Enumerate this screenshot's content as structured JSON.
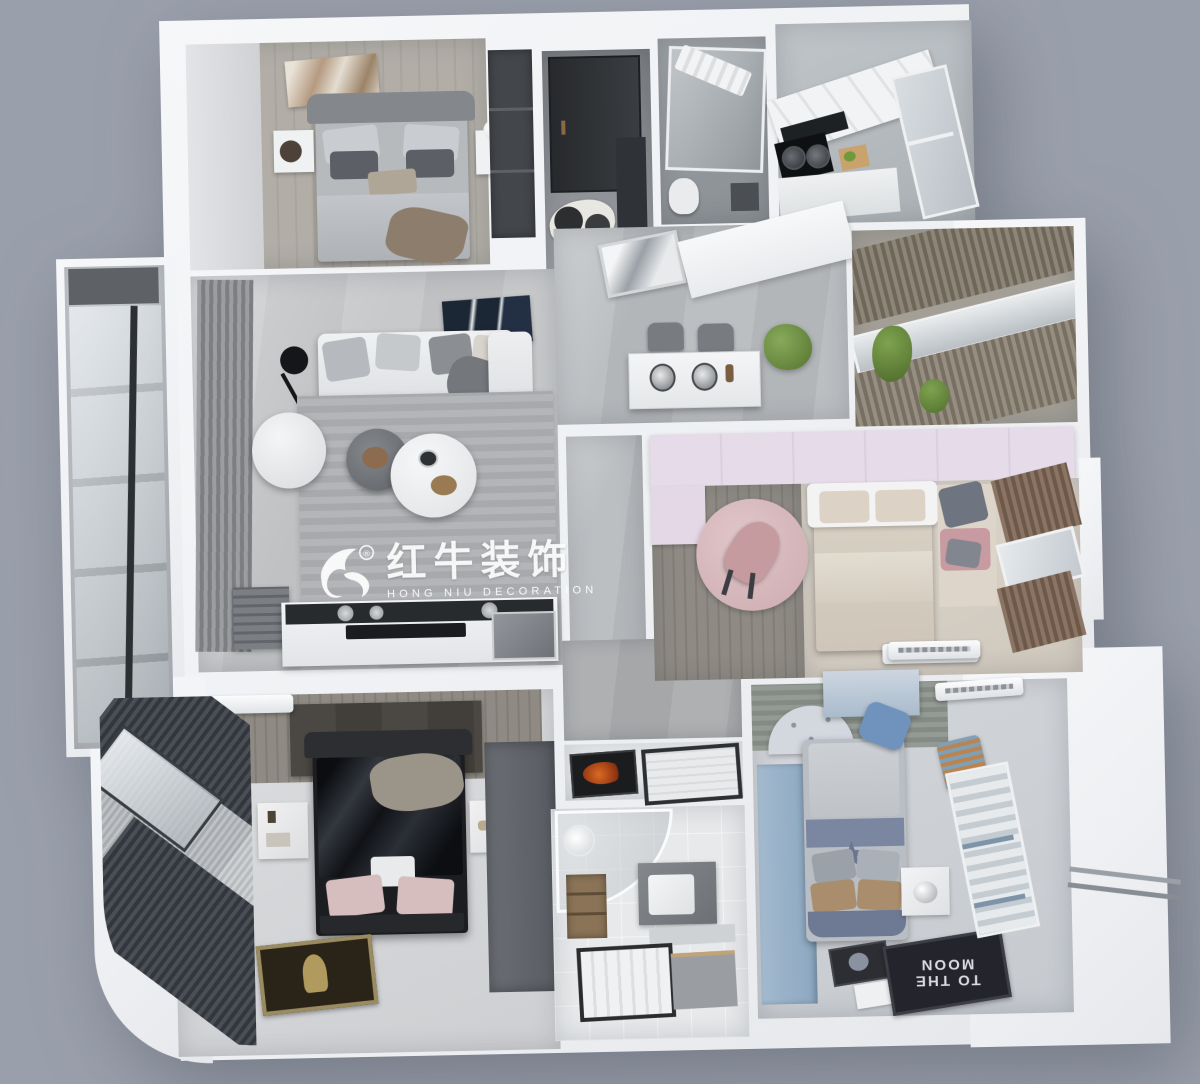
{
  "scene": {
    "description": "Top-down 3D cutaway render of a furnished three-bedroom apartment",
    "background_color": "#9aa0ab",
    "wall_color": "#f3f4f6"
  },
  "watermark": {
    "brand_cn": "红牛装饰",
    "brand_en": "HONG NIU DECORATION",
    "registered": "®"
  },
  "texts": {
    "moon_rug": "TO THE MOON"
  },
  "palette": {
    "gray_wood_floor": "#b0aca5",
    "marble_floor": "#bcbfc2",
    "entry_tile": "#85888c",
    "master_floor": "#d8d9db",
    "kids_blue": "#9db4ca",
    "kids_pink_wardrobe": "#e2d6e4",
    "pink_rug": "#d9bbbe",
    "black_bed": "#15171b",
    "plant_green": "#6b8a46",
    "flame_mat_orange": "#c8511e"
  },
  "rooms": [
    {
      "id": "second-bedroom",
      "furniture": [
        "gray double bed",
        "two white nightstands",
        "abstract artwork",
        "table lamp",
        "dark wardrobe"
      ]
    },
    {
      "id": "entry-hall",
      "furniture": [
        "black front door",
        "cowhide rug",
        "shoe cabinet"
      ]
    },
    {
      "id": "bathroom-top",
      "furniture": [
        "glass shower screen",
        "towel rail"
      ]
    },
    {
      "id": "kitchen",
      "furniture": [
        "white cabinets",
        "black range hood",
        "cooktop with two pots",
        "cutting board",
        "window"
      ]
    },
    {
      "id": "dining-area",
      "furniture": [
        "white dining table",
        "two gray chairs",
        "coffee machines",
        "potted plant",
        "wall mirror"
      ]
    },
    {
      "id": "closet-corridor",
      "furniture": [
        "wood-slat sliding wardrobe",
        "window",
        "trailing plants"
      ]
    },
    {
      "id": "living-room",
      "furniture": [
        "white sofa with cushions",
        "arc floor lamp",
        "white pouf",
        "nesting round coffee tables",
        "striped rug",
        "navy abstract art",
        "gray curtains",
        "island counter with black backsplash"
      ]
    },
    {
      "id": "girls-bedroom",
      "furniture": [
        "lavender wardrobe",
        "round pink rug with chair",
        "beige bed",
        "pink window seat",
        "brown curtains",
        "air conditioner"
      ]
    },
    {
      "id": "master-bedroom",
      "furniture": [
        "black bed with satin bedding",
        "marble nightstands",
        "dark accent wall",
        "gray wardrobe",
        "floor artwork",
        "curved bay window with curtains",
        "air conditioner"
      ]
    },
    {
      "id": "bathroom-bottom",
      "furniture": [
        "curved glass shower",
        "vanity with basin",
        "storage shelf",
        "tiled shower tray",
        "flame doormat"
      ]
    },
    {
      "id": "boys-bedroom",
      "furniture": [
        "blue wardrobe",
        "polka-dot canopy bed",
        "TO THE MOON rug",
        "moon picture",
        "white storage cube",
        "blue desk and chair",
        "striped shirt on wall",
        "window with blinds",
        "exterior drying rack",
        "air conditioners"
      ]
    },
    {
      "id": "balcony",
      "furniture": [
        "black-framed glazing"
      ]
    }
  ]
}
